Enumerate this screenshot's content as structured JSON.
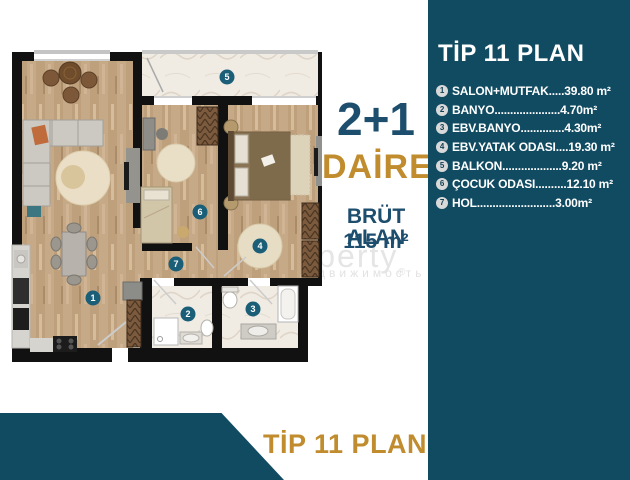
{
  "right_panel": {
    "title": "TİP 11 PLAN",
    "rooms": [
      {
        "num": "1",
        "label": "SALON+MUTFAK",
        "dots": ".....",
        "area": "39.80 m²"
      },
      {
        "num": "2",
        "label": "BANYO",
        "dots": ".....................",
        "area": "4.70m²"
      },
      {
        "num": "3",
        "label": "EBV.BANYO",
        "dots": "..............",
        "area": "4.30m²"
      },
      {
        "num": "4",
        "label": "EBV.YATAK ODASI",
        "dots": "....",
        "area": "19.30 m²"
      },
      {
        "num": "5",
        "label": "BALKON",
        "dots": "...................",
        "area": "9.20 m²"
      },
      {
        "num": "6",
        "label": "ÇOCUK ODASI",
        "dots": "..........",
        "area": "12.10 m²"
      },
      {
        "num": "7",
        "label": "HOL",
        "dots": ".........................",
        "area": " 3.00m²"
      }
    ]
  },
  "center": {
    "type_line": "2+1",
    "name_line": "DAİRE",
    "gross_label": "BRÜT ALAN",
    "gross_value": "115 m²"
  },
  "bottom_banner": {
    "title": "TİP 11 PLAN"
  },
  "watermark": {
    "line1": "property",
    "line2": "недвижимость",
    "reg": "®"
  },
  "plan": {
    "badges": [
      {
        "num": "1"
      },
      {
        "num": "2"
      },
      {
        "num": "3"
      },
      {
        "num": "4"
      },
      {
        "num": "5"
      },
      {
        "num": "6"
      },
      {
        "num": "7"
      }
    ]
  },
  "colors": {
    "panel_teal": "#114b62",
    "gold": "#c08c2e",
    "navy": "#1e4e6d",
    "badge_teal": "#1b5e78",
    "wall_black": "#111111",
    "wood_floor": "#c6a987",
    "marble_floor": "#f0ebe3"
  }
}
